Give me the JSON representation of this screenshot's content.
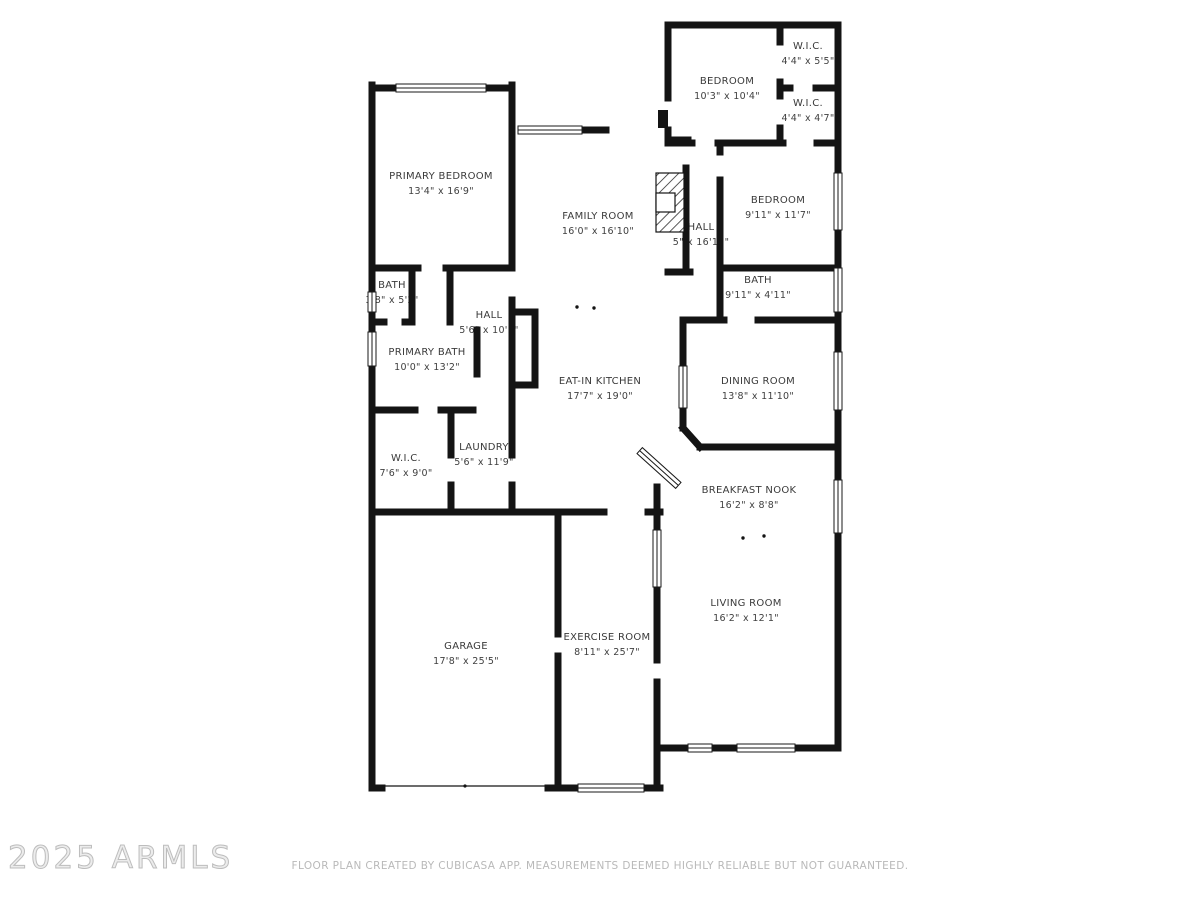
{
  "plan": {
    "wall_color": "#141414",
    "label_color": "#3a3a3a",
    "source_app": "CubiCasa"
  },
  "rooms": [
    {
      "id": "primary-bedroom",
      "name": "PRIMARY BEDROOM",
      "dims": "13'4\" x 16'9\""
    },
    {
      "id": "family-room",
      "name": "FAMILY ROOM",
      "dims": "16'0\" x 16'10\""
    },
    {
      "id": "bath-small",
      "name": "BATH",
      "dims": "3'8\" x 5'2\""
    },
    {
      "id": "hall-left",
      "name": "HALL",
      "dims": "5'6\" x 10'5\""
    },
    {
      "id": "primary-bath",
      "name": "PRIMARY BATH",
      "dims": "10'0\" x 13'2\""
    },
    {
      "id": "wic-left",
      "name": "W.I.C.",
      "dims": "7'6\" x 9'0\""
    },
    {
      "id": "laundry",
      "name": "LAUNDRY",
      "dims": "5'6\" x 11'9\""
    },
    {
      "id": "eat-in-kitchen",
      "name": "EAT-IN KITCHEN",
      "dims": "17'7\" x 19'0\""
    },
    {
      "id": "garage",
      "name": "GARAGE",
      "dims": "17'8\" x 25'5\""
    },
    {
      "id": "exercise-room",
      "name": "EXERCISE ROOM",
      "dims": "8'11\" x 25'7\""
    },
    {
      "id": "bedroom-1",
      "name": "BEDROOM",
      "dims": "10'3\" x 10'4\""
    },
    {
      "id": "wic-1",
      "name": "W.I.C.",
      "dims": "4'4\" x 5'5\""
    },
    {
      "id": "wic-2",
      "name": "W.I.C.",
      "dims": "4'4\" x 4'7\""
    },
    {
      "id": "bedroom-2",
      "name": "BEDROOM",
      "dims": "9'11\" x 11'7\""
    },
    {
      "id": "hall-right",
      "name": "HALL",
      "dims": "5\" x 16'11\""
    },
    {
      "id": "bath-2",
      "name": "BATH",
      "dims": "9'11\" x 4'11\""
    },
    {
      "id": "dining-room",
      "name": "DINING ROOM",
      "dims": "13'8\" x 11'10\""
    },
    {
      "id": "breakfast-nook",
      "name": "BREAKFAST NOOK",
      "dims": "16'2\" x 8'8\""
    },
    {
      "id": "living-room",
      "name": "LIVING ROOM",
      "dims": "16'2\" x 12'1\""
    }
  ],
  "watermark": {
    "text": "2025 ARMLS",
    "color": "#c9c9c9"
  },
  "footer": {
    "text": "FLOOR PLAN CREATED BY CUBICASA APP. MEASUREMENTS DEEMED HIGHLY RELIABLE BUT NOT GUARANTEED.",
    "color": "#b9b9b9"
  }
}
